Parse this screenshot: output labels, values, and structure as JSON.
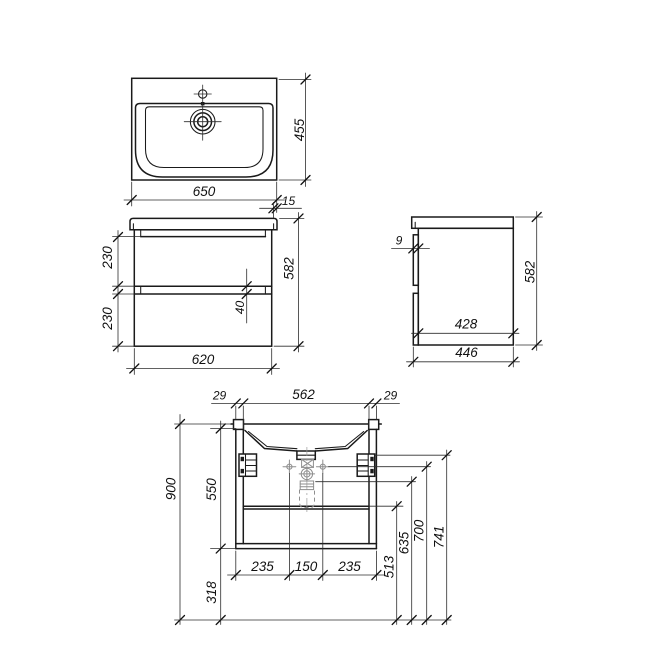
{
  "dims": {
    "sink": {
      "width": "650",
      "depth": "455",
      "overhang": "15"
    },
    "front": {
      "drawer_top": "230",
      "drawer_bottom": "230",
      "gap": "40",
      "height": "582",
      "width": "620"
    },
    "side": {
      "panel": "9",
      "inner_depth": "428",
      "depth": "446",
      "height": "582"
    },
    "install": {
      "wall_left": "29",
      "opening": "562",
      "wall_right": "29",
      "total_height": "900",
      "cabinet_span": "550",
      "floor_gap": "318",
      "offset_left": "235",
      "supply_span": "150",
      "offset_right": "235",
      "h_shelf": "513",
      "h_drain": "635",
      "h_supply": "700",
      "h_bracket": "741"
    }
  }
}
